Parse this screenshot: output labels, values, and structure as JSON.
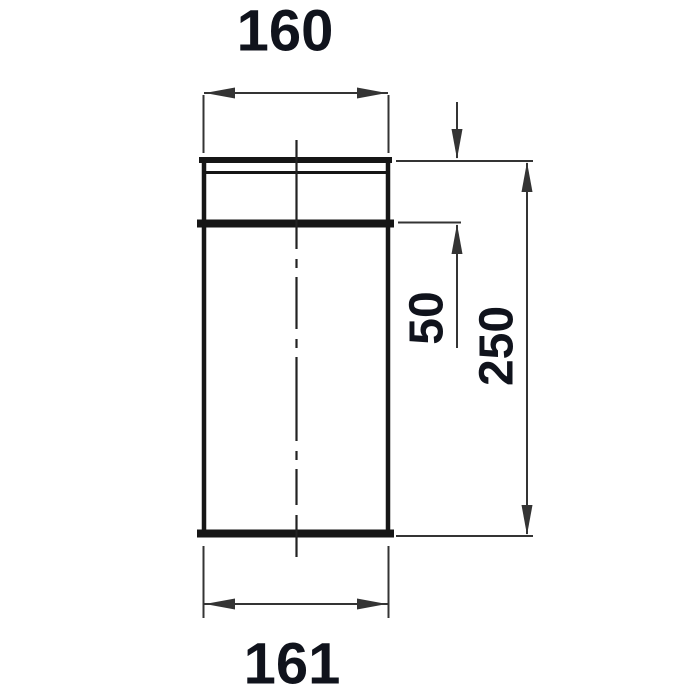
{
  "drawing": {
    "dimensions": {
      "top_diameter": "160",
      "bottom_diameter": "161",
      "socket_depth": "50",
      "overall_length": "250"
    },
    "colors": {
      "object_line": "#161616",
      "centerline": "#222222",
      "dimension_line": "#343434",
      "text": "#10131c",
      "background": "#ffffff"
    }
  }
}
